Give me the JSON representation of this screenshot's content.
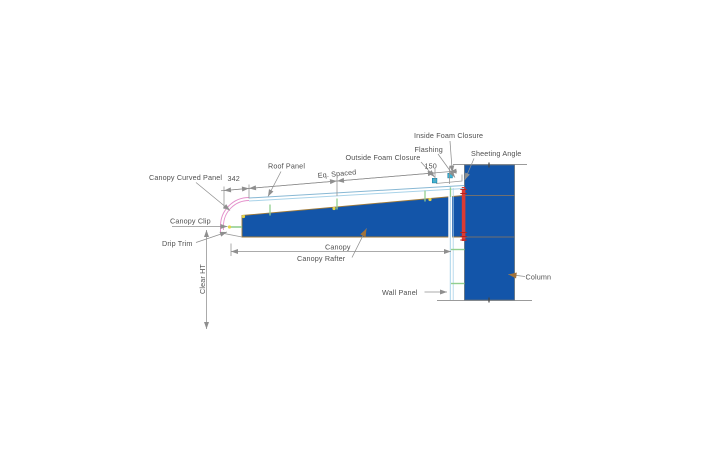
{
  "window": {
    "width": 703,
    "height": 476
  },
  "diagram": {
    "type": "technical-drawing",
    "subject": "Canopy attachment detail at steel column",
    "labels": {
      "inside_foam_closure": "Inside Foam Closure",
      "flashing": "Flashing",
      "sheeting_angle": "Sheeting Angle",
      "outside_foam_closure": "Outside Foam Closure",
      "roof_panel": "Roof Panel",
      "eq_spaced": "Eq. Spaced",
      "canopy_curved_panel": "Canopy Curved Panel",
      "canopy_clip": "Canopy Clip",
      "drip_trim": "Drip Trim",
      "clear_ht": "Clear HT",
      "canopy": "Canopy",
      "canopy_rafter": "Canopy Rafter",
      "wall_panel": "Wall Panel",
      "column": "Column"
    },
    "dimensions": {
      "curved_panel_width": "342",
      "closure_offset": "150"
    },
    "colors": {
      "bg": "#ffffff",
      "steel_blue": "#1355a9",
      "rafter_edge": "#a07a38",
      "column_edge": "#5f6d79",
      "red": "#dd3b33",
      "red_dark": "#b52320",
      "pink": "#e492cc",
      "light_blue": "#a9d3e9",
      "panel_edge_blue": "#88b8d4",
      "green": "#92cf8f",
      "yellow": "#e4d44a",
      "cyan": "#3ab6d9",
      "cyan_edge": "#1f7f9f",
      "line_gray": "#8f8f8f",
      "line_gray_light": "#9b9b9b",
      "splice_gray": "#707070",
      "text": "#4f4f4f",
      "brown": "#a2733a"
    }
  }
}
